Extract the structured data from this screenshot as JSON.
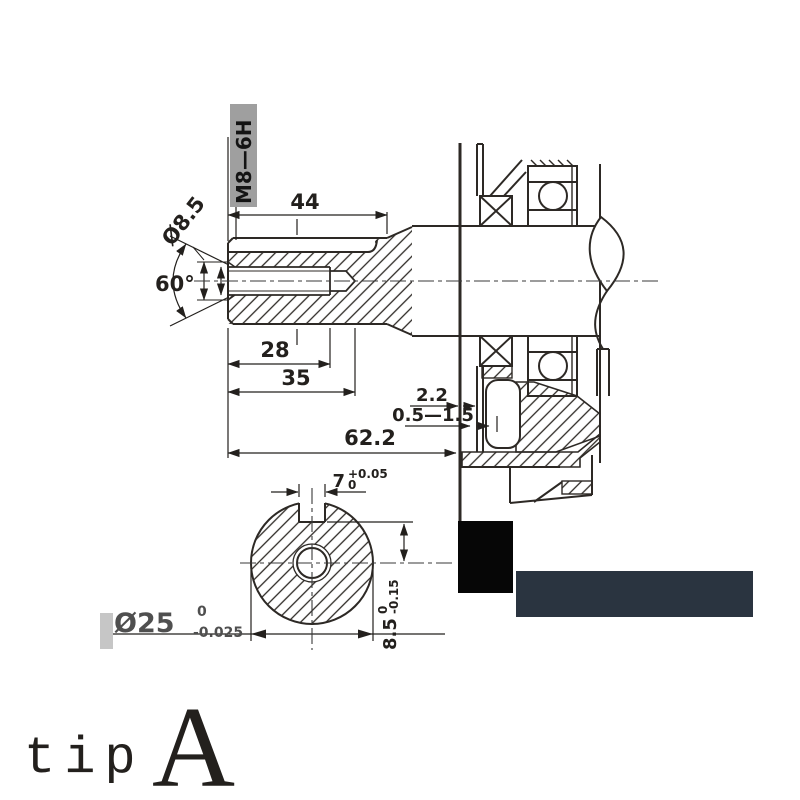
{
  "drawing": {
    "dims": {
      "keyway_length": "44",
      "thread_depth": "28",
      "drill_depth": "35",
      "total_length": "62.2",
      "seal_gap": "2.2",
      "seal_range": "0.5—1.5",
      "chamfer_angle": "60°",
      "thread_dia": "Ø8.5"
    },
    "thread_callout": "M8—6H",
    "end_view": {
      "key_width": "7",
      "key_width_tol_upper": "+0.05",
      "key_width_tol_lower": "0",
      "key_depth": "8.5",
      "key_depth_tol_upper": "0",
      "key_depth_tol_lower": "-0.15",
      "shaft_dia": "Ø25",
      "shaft_dia_tol_upper": "0",
      "shaft_dia_tol_lower": "-0.025"
    }
  },
  "watermark": {
    "text": "tip",
    "letter": "A"
  },
  "colors": {
    "line": "#2d2925",
    "watermark_red": "#e8544a",
    "navy_box": "#2a3440",
    "black_box": "#060606",
    "label_bg": "#9f9f9f",
    "dia_label_gray": "#4f4f4f"
  }
}
